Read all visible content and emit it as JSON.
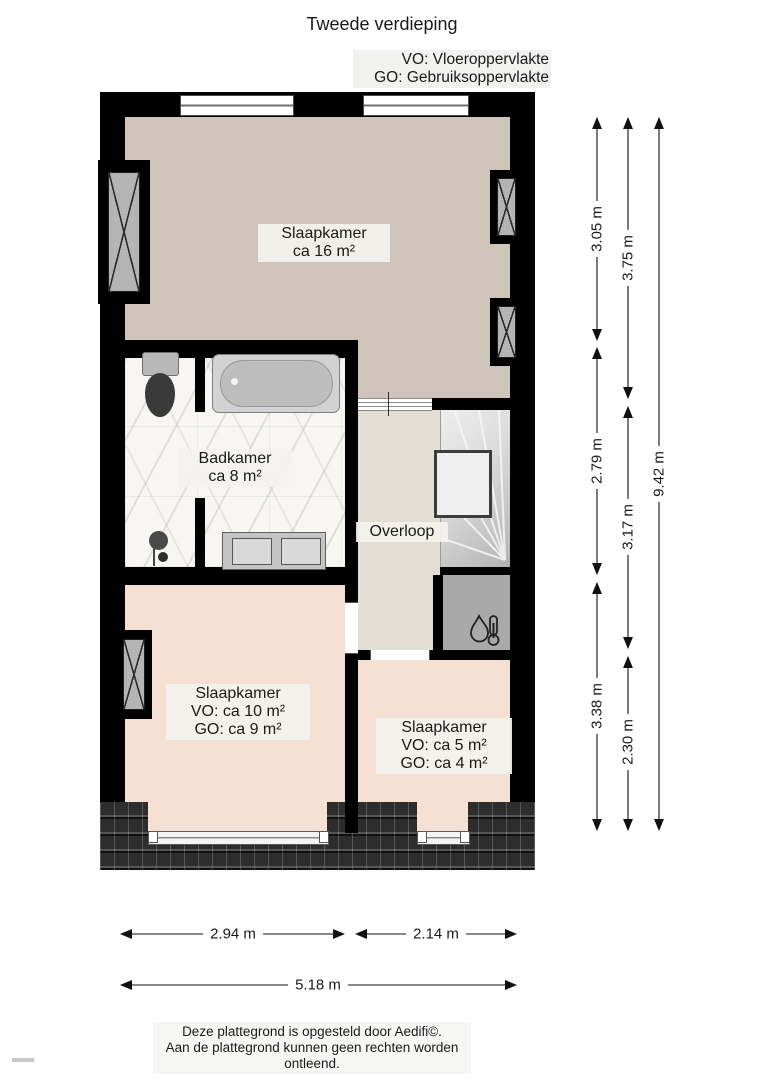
{
  "header": {
    "title": "Tweede verdieping"
  },
  "legend": {
    "line1": "VO: Vloeroppervlakte",
    "line2": "GO: Gebruiksoppervlakte"
  },
  "rooms": {
    "slaapkamer_groot": {
      "name": "Slaapkamer",
      "area": "ca 16 m²"
    },
    "badkamer": {
      "name": "Badkamer",
      "area": "ca 8 m²"
    },
    "overloop": {
      "name": "Overloop"
    },
    "slaapkamer_links": {
      "name": "Slaapkamer",
      "vo": "VO: ca 10 m²",
      "go": "GO: ca 9 m²"
    },
    "slaapkamer_rechts": {
      "name": "Slaapkamer",
      "vo": "VO: ca 5 m²",
      "go": "GO: ca 4 m²"
    }
  },
  "dimensions": {
    "vertical": [
      {
        "label": "3.05 m"
      },
      {
        "label": "2.79 m"
      },
      {
        "label": "3.38 m"
      },
      {
        "label": "3.75 m"
      },
      {
        "label": "3.17 m"
      },
      {
        "label": "2.30 m"
      },
      {
        "label": "9.42 m"
      }
    ],
    "horizontal": [
      {
        "label": "2.94 m"
      },
      {
        "label": "2.14 m"
      },
      {
        "label": "5.18 m"
      }
    ]
  },
  "footer": {
    "line1": "Deze plattegrond is opgesteld door Aedifi©.",
    "line2": "Aan de plattegrond kunnen geen rechten worden ontleend."
  },
  "colors": {
    "wall": "#000000",
    "bedroom_large_floor": "#cfc4ba",
    "bedroom_floor": "#f6e0d4",
    "landing_floor": "#e3ded5",
    "bathroom_floor": "#f7f6f3",
    "stairs": "#d9d9d9",
    "closet": "#a9a9a9",
    "roof": "#2d2d2d"
  }
}
